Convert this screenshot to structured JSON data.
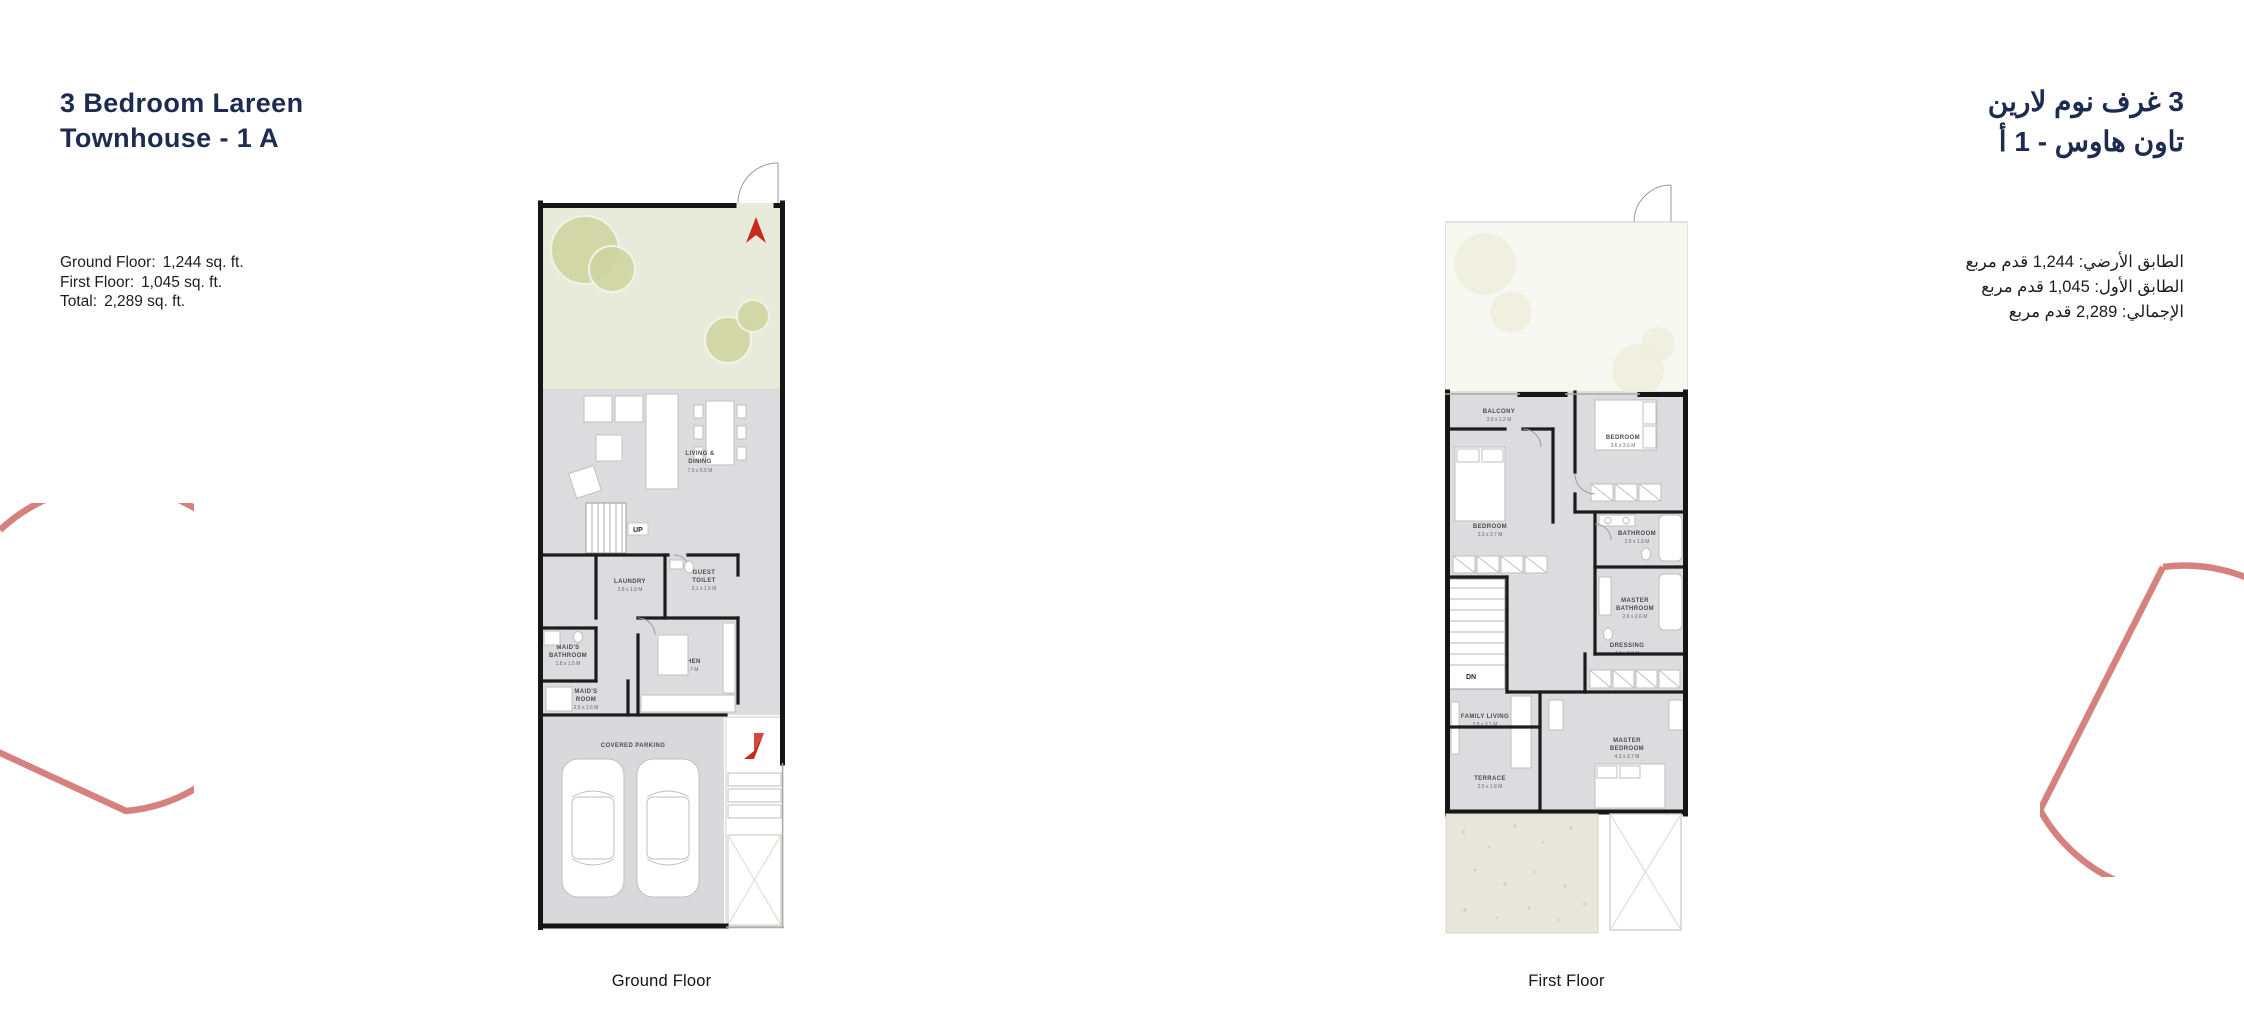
{
  "colors": {
    "navy": "#1c2b4f",
    "salmon": "#d5827e",
    "garden_green": "#e8ebda",
    "tree_olive": "#ccd39e",
    "room_gray": "#dcdcde",
    "wall_black": "#161616",
    "north_red": "#c9281c",
    "gravel_beige": "#e9e6db"
  },
  "left_panel": {
    "title_line1": "3 Bedroom Lareen",
    "title_line2": "Townhouse - 1 A",
    "areas": [
      {
        "label": "Ground Floor:",
        "value": "1,244 sq. ft."
      },
      {
        "label": "First Floor:",
        "value": "1,045 sq. ft."
      },
      {
        "label": "Total:",
        "value": "2,289  sq. ft."
      }
    ]
  },
  "right_panel": {
    "title_line1": "3 غرف نوم لارين",
    "title_line2": "تاون هاوس - 1 أ",
    "areas": [
      {
        "text": "الطابق الأرضي:  1,244 قدم مربع"
      },
      {
        "text": "الطابق الأول:  1,045 قدم مربع"
      },
      {
        "text": "الإجمالي:   2,289 قدم مربع"
      }
    ]
  },
  "ground_floor": {
    "caption": "Ground Floor",
    "stairs_label": "UP",
    "rooms": {
      "living_dining": {
        "line1": "LIVING &",
        "line2": "DINING",
        "dims": "7.0 x 5.5 M"
      },
      "laundry": {
        "line1": "LAUNDRY",
        "dims": "2.8 x 1.9 M"
      },
      "guest_toilet": {
        "line1": "GUEST",
        "line2": "TOILET",
        "dims": "2.1 x 1.5 M"
      },
      "maids_bathroom": {
        "line1": "MAID'S",
        "line2": "BATHROOM",
        "dims": "1.8 x 1.5 M"
      },
      "maids_room": {
        "line1": "MAID'S",
        "line2": "ROOM",
        "dims": "2.5 x 1.6 M"
      },
      "kitchen": {
        "line1": "KITCHEN",
        "dims": "5.0 x 3.7 M"
      },
      "covered_parking": {
        "line1": "COVERED PARKING"
      }
    }
  },
  "first_floor": {
    "caption": "First Floor",
    "stairs_label": "DN",
    "rooms": {
      "balcony": {
        "line1": "BALCONY",
        "dims": "3.0 x 1.2 M"
      },
      "bedroom_left": {
        "line1": "BEDROOM",
        "dims": "3.3 x 3.7 M"
      },
      "bedroom_right": {
        "line1": "BEDROOM",
        "dims": "3.6 x 3.6 M"
      },
      "bathroom": {
        "line1": "BATHROOM",
        "dims": "2.5 x 1.9 M"
      },
      "master_bathroom": {
        "line1": "MASTER",
        "line2": "BATHROOM",
        "dims": "2.6 x 2.6 M"
      },
      "dressing": {
        "line1": "DRESSING",
        "dims": "4.2 x 3.2 M"
      },
      "family_living": {
        "line1": "FAMILY LIVING",
        "dims": "3.5 x 3.1 M"
      },
      "master_bedroom": {
        "line1": "MASTER",
        "line2": "BEDROOM",
        "dims": "4.3 x 3.7 M"
      },
      "terrace": {
        "line1": "TERRACE",
        "dims": "2.5 x 1.8 M"
      }
    }
  }
}
